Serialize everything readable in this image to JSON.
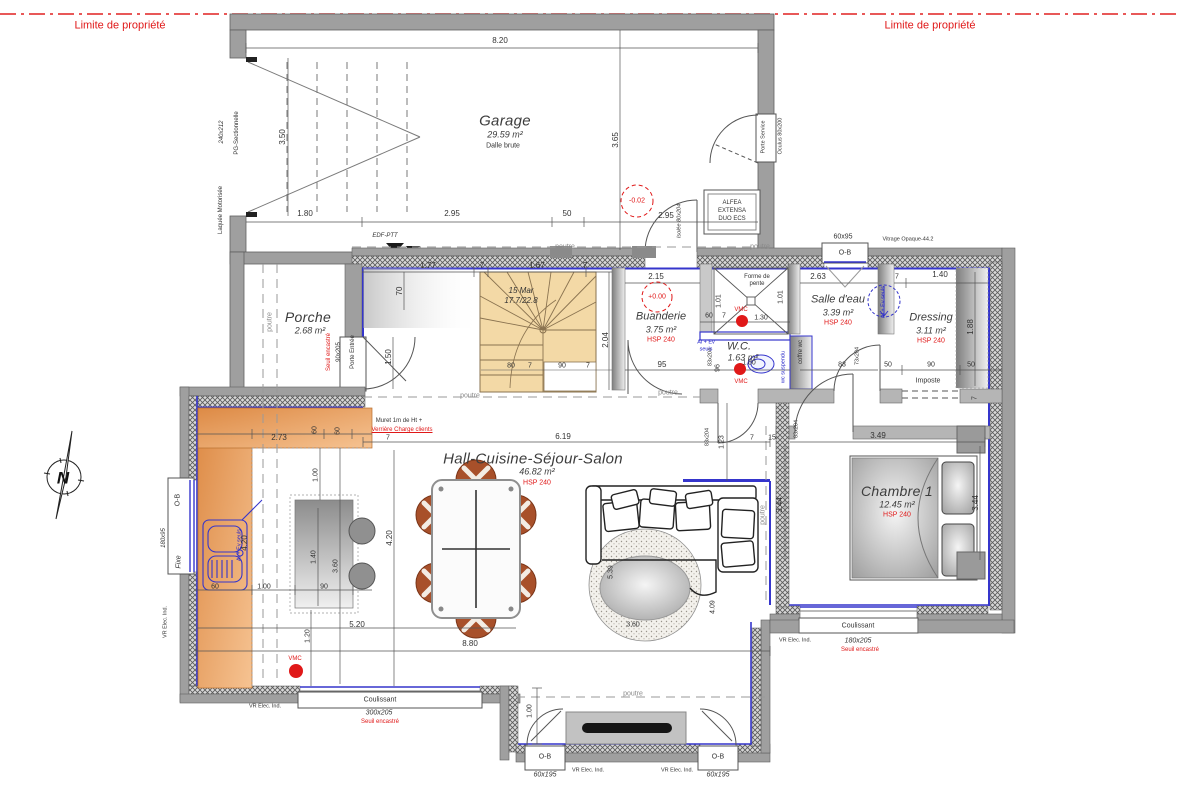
{
  "property": {
    "limit": "Limite de propriété"
  },
  "compass": {
    "n": "N"
  },
  "beam": {
    "poutre": "poutre"
  },
  "garage": {
    "name": "Garage",
    "area": "29.59 m²",
    "note": "Dalle brute",
    "level": "-0.02",
    "dim_top": "8.20",
    "dim_side": "3.65",
    "dim_door": "3.50",
    "c1": "1.80",
    "c2": "2.95",
    "c3": "50",
    "c4": "2.95",
    "door_size": "240x212",
    "door_type": "PG-Sectionnelle",
    "door_finish": "Laquée Motorisée",
    "inner_door": "Isolée 80x204",
    "service_door": "Porte Service",
    "oculus": "Oculus 80x200",
    "heater1": "ALFEA",
    "heater2": "EXTENSA",
    "heater3": "DUO ECS",
    "edf": "EDF-PTT"
  },
  "porche": {
    "name": "Porche",
    "area": "2.68 m²",
    "seuil": "Seuil encastré",
    "door_size": "90x205",
    "door": "Porte Entrée",
    "d1": "1.50",
    "d2": "70"
  },
  "stairs": {
    "l1": "15 Mar",
    "l2": "17.7/22.8",
    "d1": "1.77",
    "d2": "7",
    "d3": "1.67",
    "d4": "7",
    "d5": "80",
    "d6": "7",
    "d7": "90",
    "d8": "7",
    "d9": "2.04"
  },
  "buanderie": {
    "name": "Buanderie",
    "area": "3.75 m²",
    "hsp": "HSP 240",
    "level": "+0.00",
    "d1": "2.15",
    "d2": "95",
    "door": "83x204",
    "d3": "60",
    "d4": "7",
    "d5": "1.30"
  },
  "wc": {
    "name": "W.C.",
    "area": "1.63 m²",
    "alev1": "Al + Ev",
    "alev2": "seuls",
    "d1": "96",
    "d2": "1.80",
    "susp": "wc suspendu",
    "coffre": "coffre wc",
    "vmc": "VMC"
  },
  "shower": {
    "note1": "Forme de",
    "note2": "pente",
    "d1": "1.01",
    "d2": "1.01"
  },
  "salle_eau": {
    "name": "Salle d'eau",
    "area": "3.39 m²",
    "hsp": "HSP 240",
    "d1": "2.63",
    "d2": "83",
    "door": "73x204",
    "alev": "Al + Ev seuls"
  },
  "dressing": {
    "name": "Dressing",
    "area": "3.11 m²",
    "hsp": "HSP 240",
    "d1": "7",
    "d2": "1.40",
    "d3": "1.88",
    "d4": "50",
    "d5": "90",
    "d6": "50",
    "imposte": "Imposte",
    "d7": "7"
  },
  "hall": {
    "name": "Hall-Cuisine-Séjour-Salon",
    "area": "46.82 m²",
    "hsp": "HSP 240",
    "muret1": "Muret 1m de Ht +",
    "muret2": "Verrière Charge clients",
    "d1": "6.19",
    "d2": "4.20",
    "d3": "5.39",
    "d4": "4.09",
    "d5": "3.60",
    "d6": "3.44",
    "d7": "1.23",
    "d8": "7",
    "d9": "15",
    "door": "83x204",
    "d10": "1.00"
  },
  "kitchen": {
    "d1": "2.73",
    "d2": "60",
    "d3": "60",
    "d4": "7",
    "d5": "1.00",
    "d6": "4.20",
    "d7": "1.40",
    "d8": "3.60",
    "d9": "90",
    "d10": "60",
    "d11": "1.00",
    "d12": "5.20",
    "d13": "1.20",
    "d14": "8.80",
    "alev": "Al + Ev seuls",
    "vmc": "VMC"
  },
  "chambre": {
    "name": "Chambre 1",
    "area": "12.45 m²",
    "hsp": "HSP 240",
    "d1": "3.49",
    "d2": "3.44",
    "door": "83x204"
  },
  "openings": {
    "ob": "O-B",
    "w1": "60x95",
    "vitrage": "Vitrage Opaque-44.2",
    "w2": "180x95",
    "fixe": "Fixe",
    "vr": "VR Elec. Ind.",
    "coulissant": "Coulissant",
    "c1": "300x205",
    "c2": "180x205",
    "seuil": "Seuil encastré",
    "w3": "60x195"
  }
}
